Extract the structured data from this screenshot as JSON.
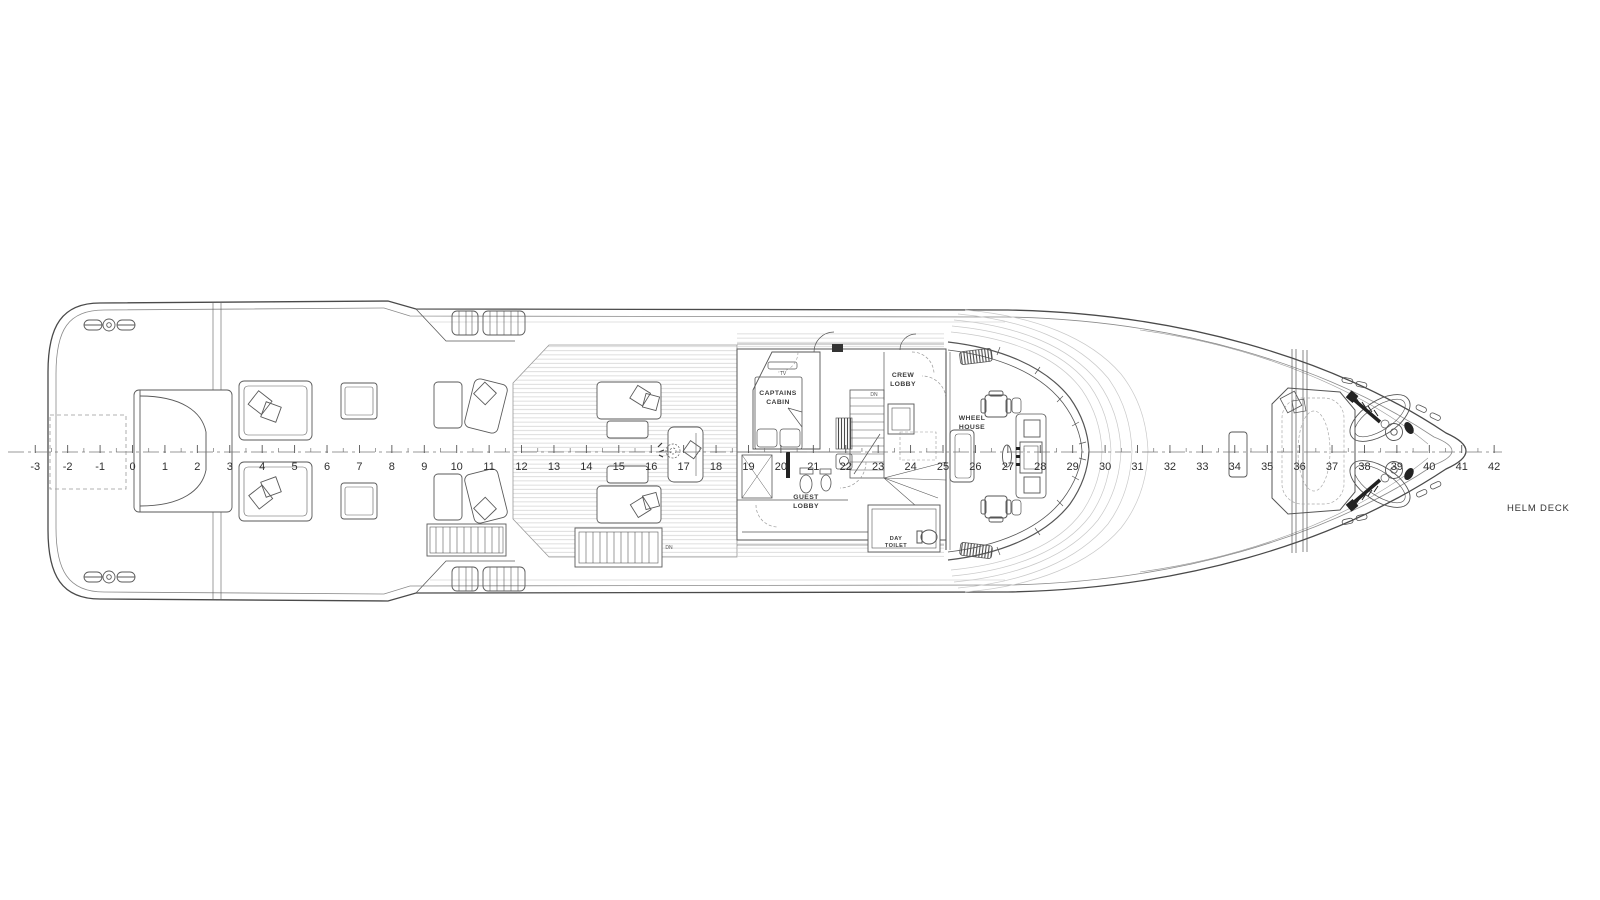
{
  "drawing": {
    "deck_title": "HELM DECK",
    "rooms": {
      "captains_cabin": [
        "CAPTAINS",
        "CABIN"
      ],
      "crew_lobby": [
        "CREW",
        "LOBBY"
      ],
      "wheel_house": [
        "WHEEL",
        "HOUSE"
      ],
      "guest_lobby": [
        "GUEST",
        "LOBBY"
      ],
      "day_toilet": [
        "DAY",
        "TOILET"
      ]
    },
    "annotations": {
      "tv": "TV",
      "dn_stairs": "DN",
      "dn_deck": "DN"
    },
    "ruler": {
      "min": -3,
      "max": 42,
      "origin_x": 132.5,
      "px_per_unit": 32.42,
      "axis_y": 452,
      "number_y": 470
    },
    "colors": {
      "background": "#ffffff",
      "outline": "#4a4a4a",
      "wall": "#5a5a5a",
      "furniture": "#6a6a6a",
      "light_line": "#b5b5b5",
      "plank": "#cfcfcf",
      "text": "#3c3c3c"
    }
  }
}
